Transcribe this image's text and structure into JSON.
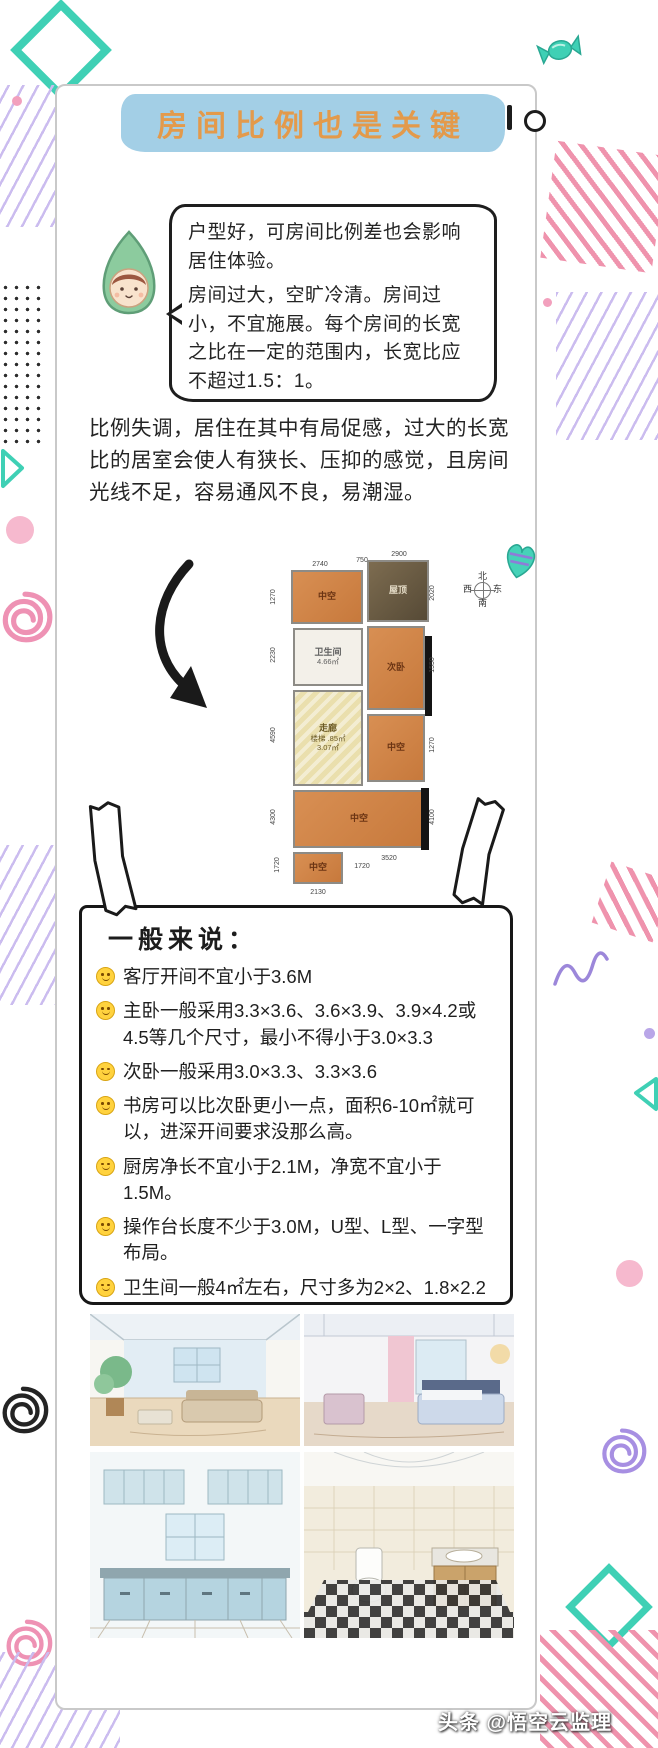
{
  "title": {
    "text": "房间比例也是关键"
  },
  "speech_bubble": {
    "para1": "户型好，可房间比例差也会影响居住体验。",
    "para2": "房间过大，空旷冷清。房间过小，不宜施展。每个房间的长宽之比在一定的范围内，长宽比应不超过1.5：1。"
  },
  "paragraph": "比例失调，居住在其中有局促感，过大的长宽比的居室会使人有狭长、压抑的感觉，且房间光线不足，容易通风不良，易潮湿。",
  "floorplan": {
    "compass": {
      "north": "北",
      "south": "南",
      "east": "东",
      "west": "西"
    },
    "rooms": {
      "top_left_void": {
        "name": "中空"
      },
      "roof": {
        "name": "屋顶"
      },
      "bathroom": {
        "name": "卫生间",
        "area": "4.66㎡"
      },
      "second_bedroom": {
        "name": "次卧"
      },
      "corridor": {
        "line1": "走廊",
        "line2": "楼梯 .85㎡",
        "line3": "3.07㎡"
      },
      "mid_void": {
        "name": "中空"
      },
      "large_void": {
        "name": "中空"
      },
      "small_void": {
        "name": "中空"
      }
    },
    "dimensions": {
      "top_1": "2740",
      "top_2": "750",
      "top_3": "2900",
      "left_1": "1270",
      "left_2": "2230",
      "left_3": "4590",
      "left_4": "4300",
      "right_1": "2020",
      "right_2": "1550",
      "right_3": "1270",
      "right_4": "4100",
      "bottom_1": "3520",
      "bottom_2": "2130",
      "small_left": "1720",
      "small_right": "1720"
    }
  },
  "guidelines": {
    "title": "一般来说：",
    "items": [
      "客厅开间不宜小于3.6M",
      "主卧一般采用3.3×3.6、3.6×3.9、3.9×4.2或4.5等几个尺寸，最小不得小于3.0×3.3",
      "次卧一般采用3.0×3.3、3.3×3.6",
      "书房可以比次卧更小一点，面积6-10㎡就可以，进深开间要求没那么高。",
      "厨房净长不宜小于2.1M，净宽不宜小于1.5M。",
      "操作台长度不少于3.0M，U型、L型、一字型布局。",
      "卫生间一般4㎡左右，尺寸多为2×2、1.8×2.2"
    ]
  },
  "watermark": "头条 @悟空云监理",
  "colors": {
    "banner_blue": "#a3cfe6",
    "title_orange": "#e39a4b",
    "teal": "#3fd0b5",
    "purple": "#cbbcef",
    "pink": "#ef93ad",
    "plan_orange": "#d0854c",
    "smiley_yellow": "#ffd23e"
  },
  "gallery_panels": [
    "living-room-sketch-1",
    "living-room-sketch-2",
    "kitchen-sketch",
    "bathroom-sketch"
  ]
}
